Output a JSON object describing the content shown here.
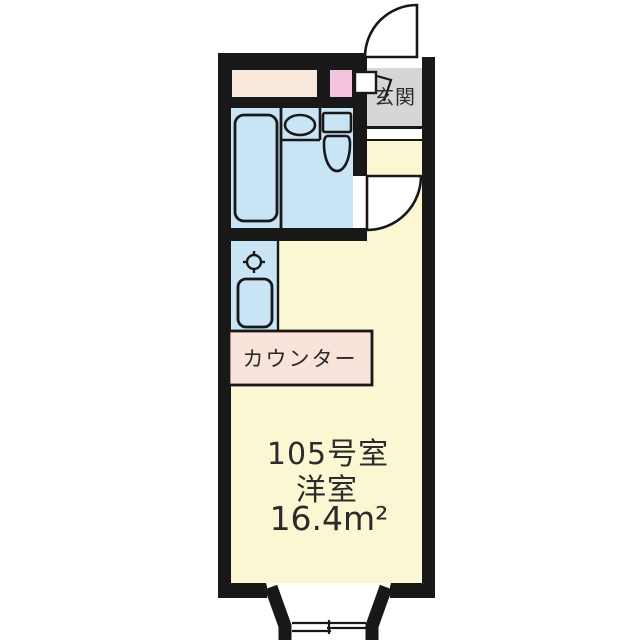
{
  "floor_plan": {
    "unit_label": "105号室",
    "room_type": "洋室",
    "area": "16.4m²",
    "entrance_label": "玄関",
    "counter_label": "カウンター"
  },
  "colors": {
    "wall": "#181818",
    "room_floor": "#FBF7D3",
    "wet_area": "#C9E4F4",
    "closet": "#F8E9DC",
    "pink_storage": "#F4C4DE",
    "counter": "#F9E3DA",
    "entrance_floor": "#D6D6D6",
    "fixture_white": "#FFFFFF"
  }
}
